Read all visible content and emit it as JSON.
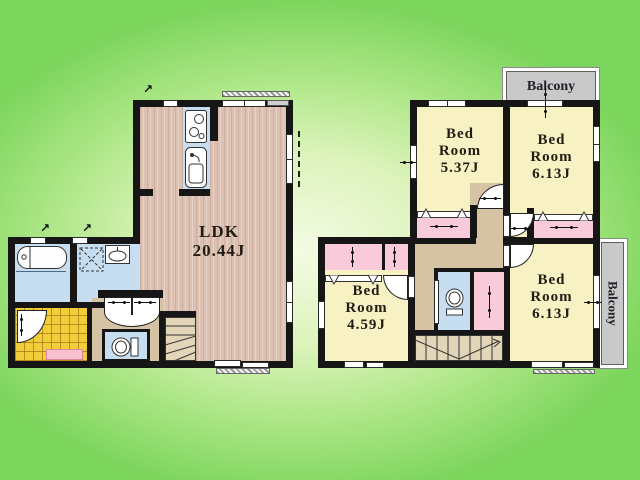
{
  "plan_type": "residential floor plan, two floors",
  "colors": {
    "wall": "#161616",
    "wood_floor": "#dcc1b3",
    "water_rooms": "#c7ddf0",
    "bedroom": "#f8f1c4",
    "closet": "#f9cbda",
    "hallway": "#d6c3a4",
    "stairs": "#e2d5b8",
    "entrance_tile": "#f0cd39",
    "mat": "#f9c0d0",
    "balcony": "#c9c9c9",
    "background_edge": "#7cd55c",
    "background_center": "#f3fbe2"
  },
  "floor1": {
    "ldk": {
      "name": "LDK",
      "size": "20.44J"
    }
  },
  "floor2": {
    "rooms": [
      {
        "id": "bedroom-537",
        "line1": "Bed",
        "line2": "Room",
        "size": "5.37J"
      },
      {
        "id": "bedroom-613-top",
        "line1": "Bed",
        "line2": "Room",
        "size": "6.13J"
      },
      {
        "id": "bedroom-459",
        "line1": "Bed",
        "line2": "Room",
        "size": "4.59J"
      },
      {
        "id": "bedroom-613-bottom",
        "line1": "Bed",
        "line2": "Room",
        "size": "6.13J"
      }
    ],
    "balcony_top": {
      "label": "Balcony"
    },
    "balcony_right": {
      "label": "Balcony"
    }
  }
}
